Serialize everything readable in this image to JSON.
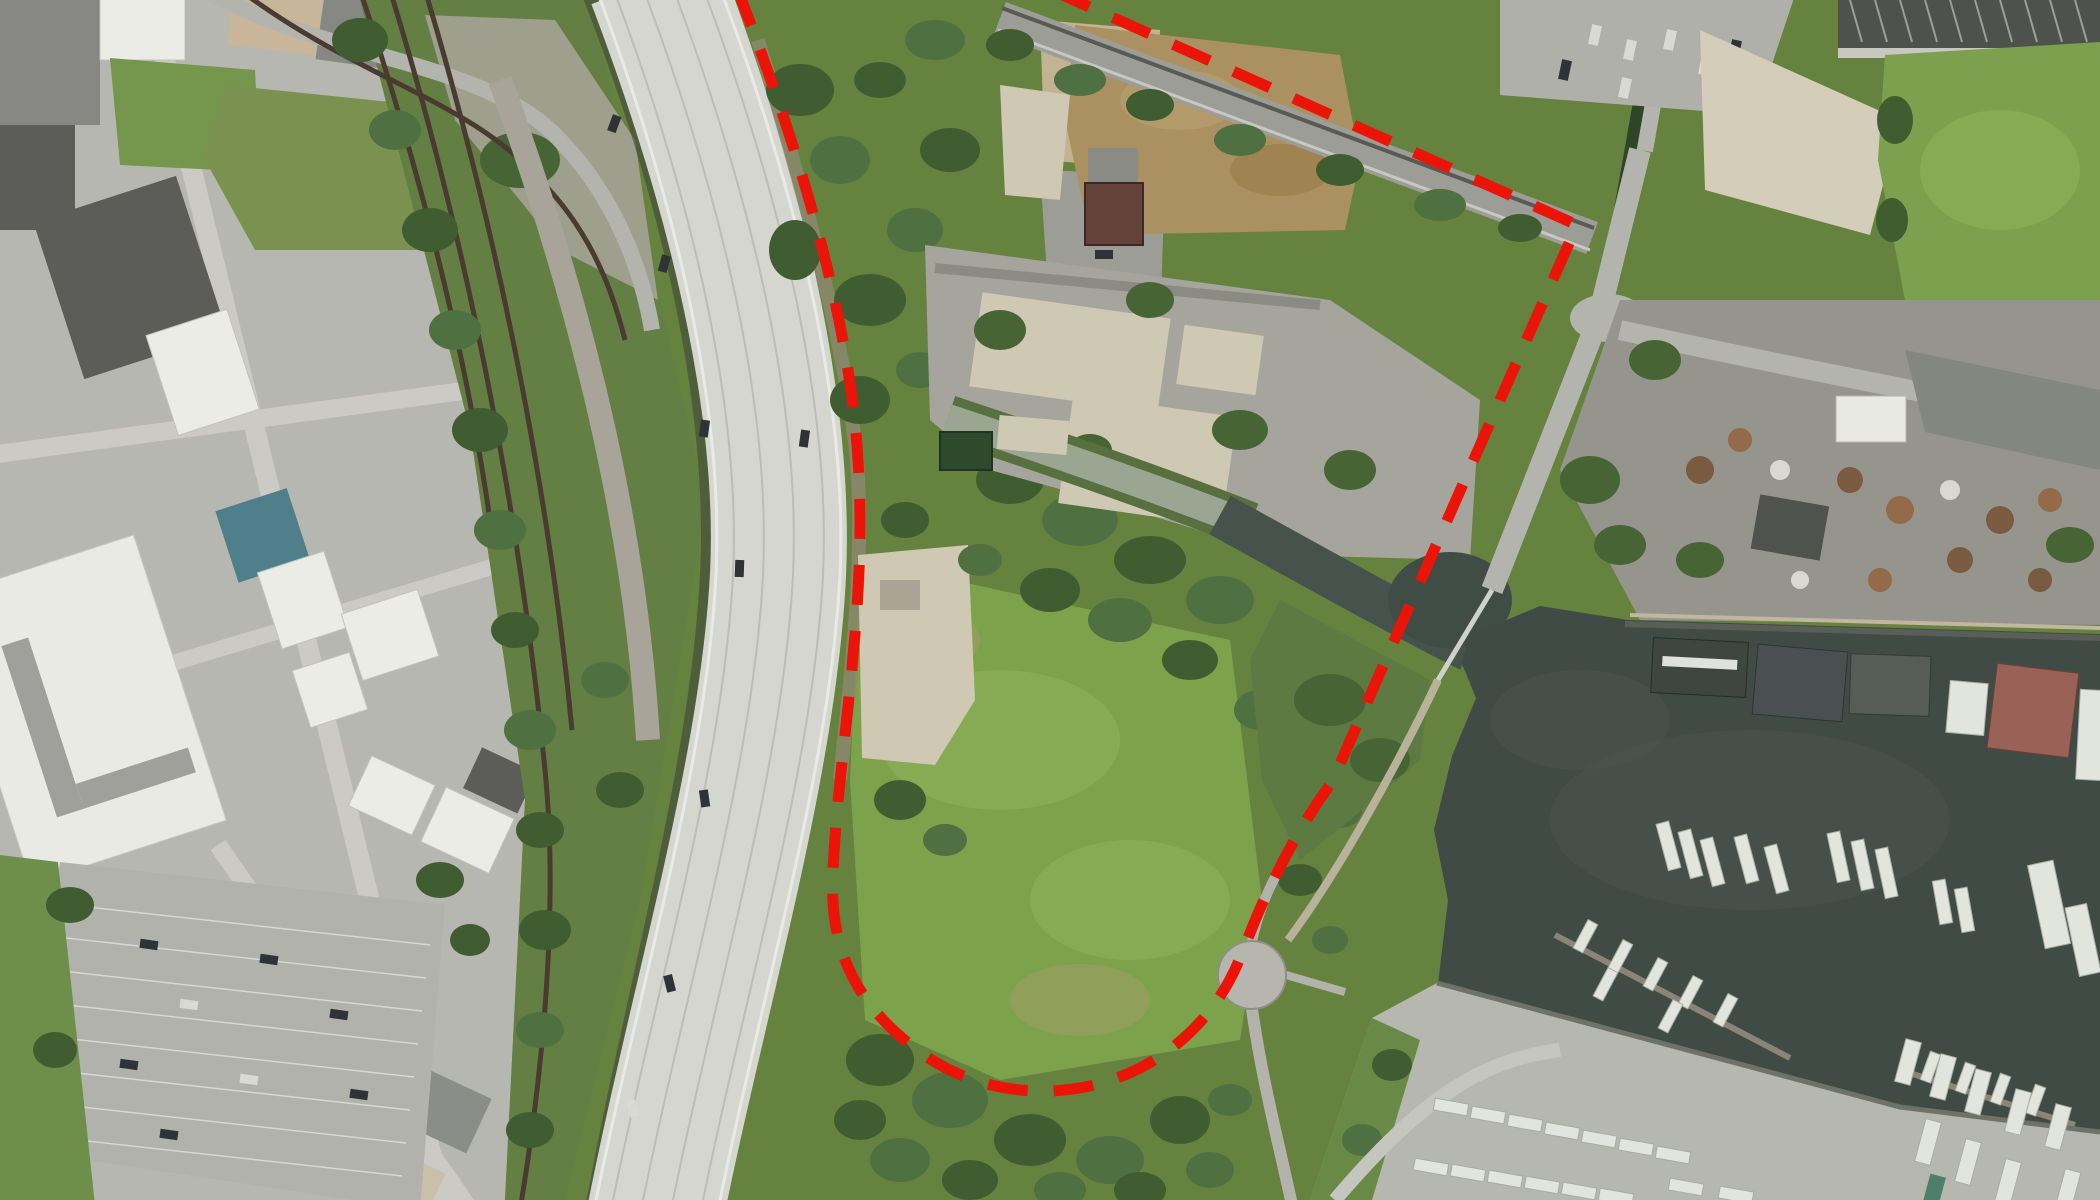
{
  "screenshot": {
    "type": "aerial-satellite-image",
    "visible_text": "none",
    "description": "Top-down aerial photo: city blocks, rail corridor and curving elevated highway on the left; vacant overgrown parcel in the center outlined with a red dashed site boundary; tidal creek joining a dark river; marina docks, boatyard and industrial scrapyard on the right."
  },
  "annotation": {
    "name": "site-boundary",
    "shape": "dashed-polyline",
    "color": "#eb1408",
    "stroke_width": 11,
    "dash_pattern": "40 26",
    "path": "M 737 -12 C 780 100 848 290 858 460 C 868 610 838 750 833 872 C 828 955 862 1010 920 1052 C 975 1092 1045 1100 1105 1082 C 1165 1064 1215 1020 1240 958 C 1252 928 1258 912 1266 896 C 1288 848 1310 812 1332 782 L 1577 225 L 1047 -12"
  },
  "palette": {
    "grass_base": "#66823f",
    "meadow": "#7da24c",
    "trees": "#3f5d30",
    "creek": "#9aa692",
    "creek_bank": "#587040",
    "river": "#414b45",
    "marsh": "#5d7a43",
    "highway": "#d6d6d1",
    "highway_shadow": "#3c4237",
    "corridor_green": "#647f43",
    "city_ground": "#b7b7b1",
    "dirt_field": "#ab9162",
    "pavement_ruins": "#a5a59e",
    "gravel": "#a8a49a",
    "scrapyard": "#95958d",
    "boatyard": "#b6b8b0",
    "maroon_roof": "#64423a",
    "teal_roof": "#4f7f8a",
    "pink_barge": "#9a6257"
  },
  "features": [
    {
      "name": "red-dashed-site-boundary",
      "kind": "annotation"
    },
    {
      "name": "elevated-highway",
      "kind": "road"
    },
    {
      "name": "railroad-corridor",
      "kind": "rail"
    },
    {
      "name": "city-blocks",
      "kind": "urban"
    },
    {
      "name": "large-parking-lot",
      "kind": "parking"
    },
    {
      "name": "vacant-parcel",
      "kind": "land"
    },
    {
      "name": "ruined-pavement-pads",
      "kind": "land"
    },
    {
      "name": "dirt-lot",
      "kind": "land"
    },
    {
      "name": "tidal-creek",
      "kind": "water"
    },
    {
      "name": "river",
      "kind": "water"
    },
    {
      "name": "marsh",
      "kind": "water-edge"
    },
    {
      "name": "marina-docks",
      "kind": "marine"
    },
    {
      "name": "boatyard",
      "kind": "marine"
    },
    {
      "name": "scrapyard",
      "kind": "industrial"
    },
    {
      "name": "truck-depot-rows",
      "kind": "industrial"
    },
    {
      "name": "cul-de-sac-overlook",
      "kind": "path"
    },
    {
      "name": "footbridge",
      "kind": "path"
    }
  ]
}
